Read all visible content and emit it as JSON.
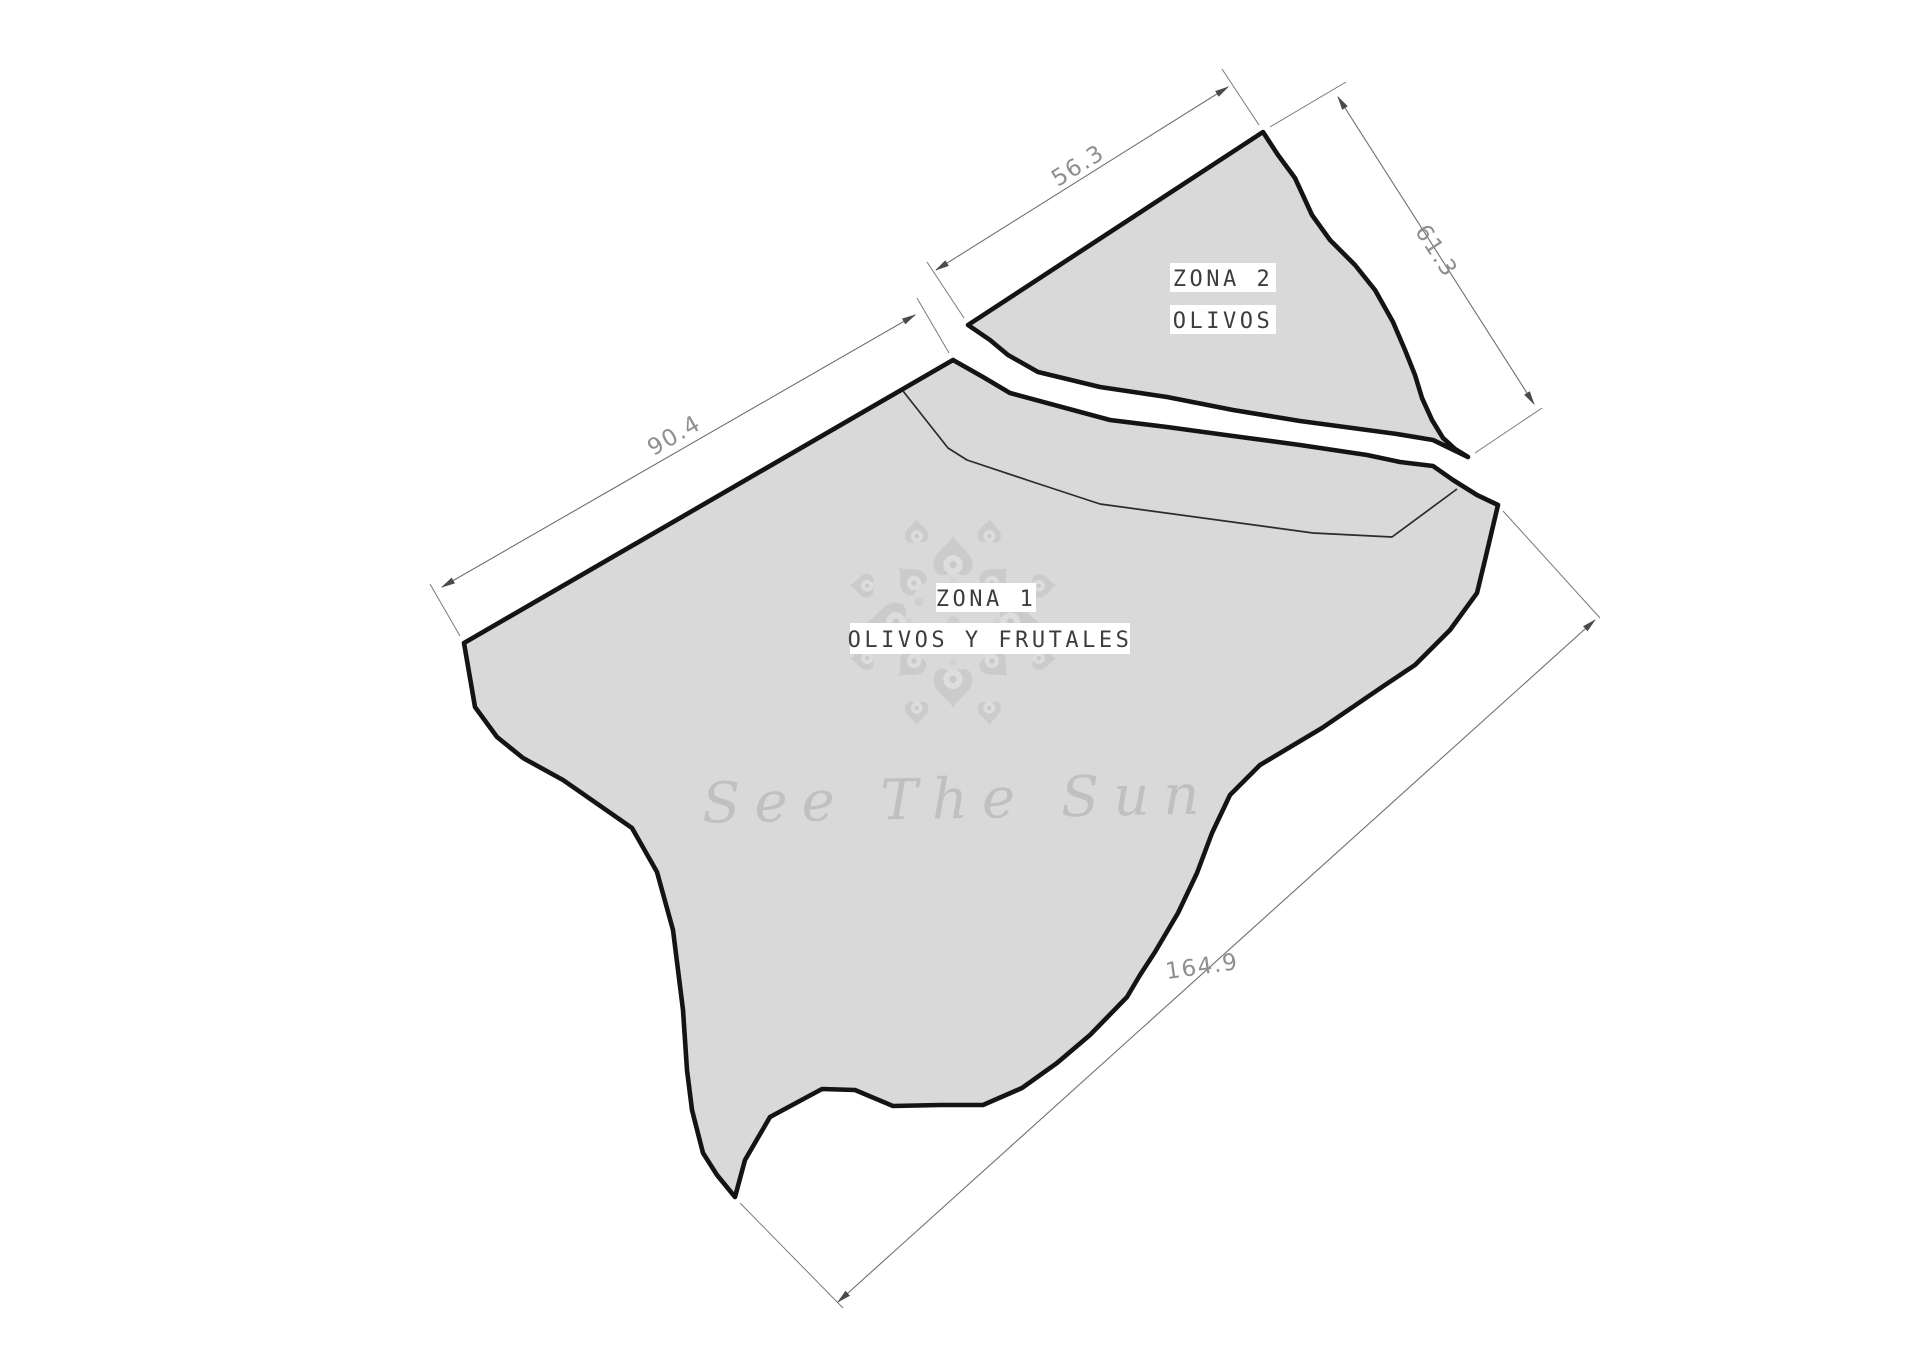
{
  "zones": {
    "zone1": {
      "name": "ZONA 1",
      "subtitle": "OLIVOS Y FRUTALES"
    },
    "zone2": {
      "name": "ZONA 2",
      "subtitle": "OLIVOS"
    }
  },
  "dimensions": {
    "top_edge": "56.3",
    "right_edge": "61.3",
    "left_edge": "90.4",
    "bottom_right_edge": "164.9"
  },
  "watermark": {
    "text": "See The Sun"
  },
  "colors": {
    "parcel_fill": "#d9d9d9",
    "outline": "#141414",
    "dimension_line": "#6f6f6f",
    "dimension_text": "#8f8f8f",
    "label_text": "#3d3d3d",
    "label_bg": "#ffffff",
    "watermark_text": "#bcbcbc",
    "mandala_dark": "#c9c9c9",
    "mandala_light": "#dedede"
  }
}
